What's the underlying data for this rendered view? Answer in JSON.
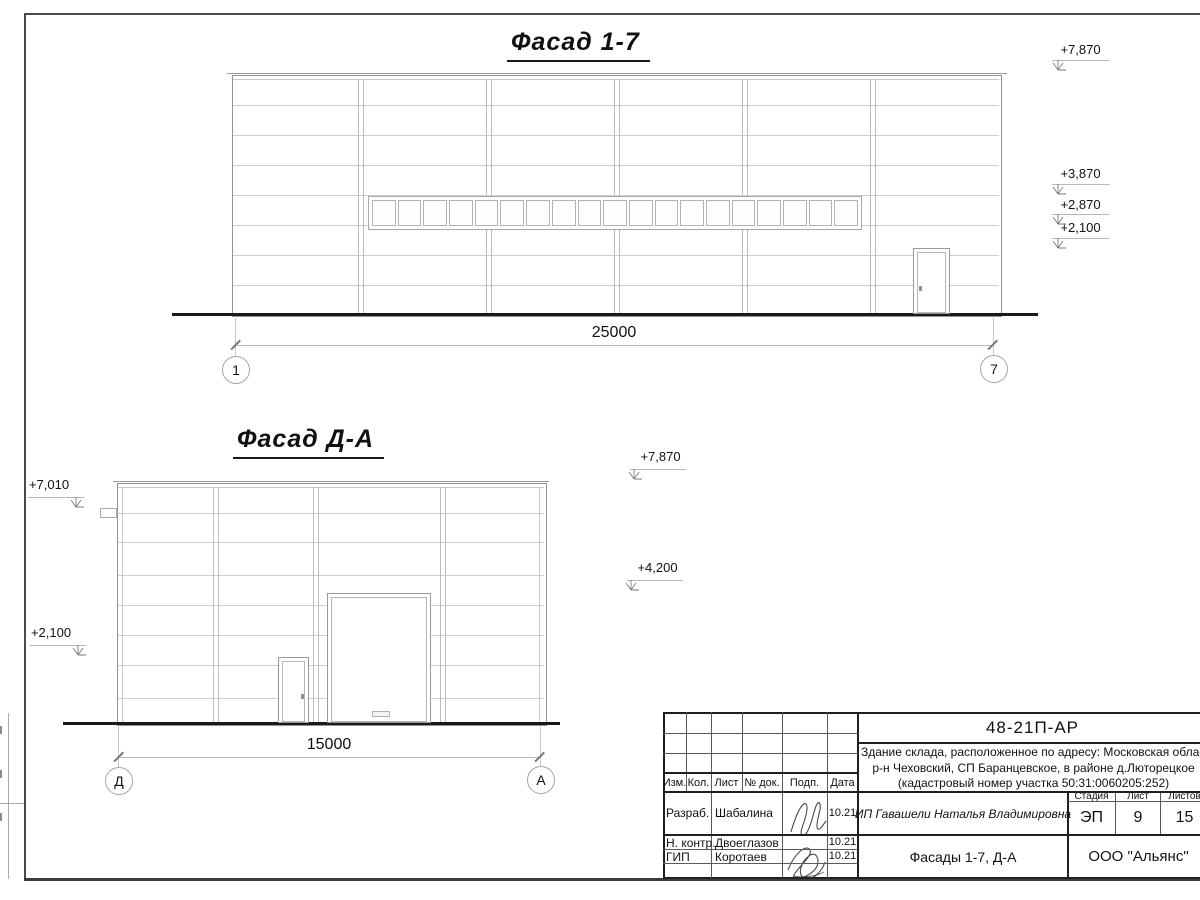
{
  "facade_1_7": {
    "title": "Фасад 1-7",
    "elevation_marks": [
      "+7,870",
      "+3,870",
      "+2,870",
      "+2,100"
    ],
    "dimension": "25000",
    "axis_start": "1",
    "axis_end": "7"
  },
  "facade_d_a": {
    "title": "Фасад Д-А",
    "elevation_marks_left": [
      "+7,010",
      "+2,100"
    ],
    "elevation_marks_right": [
      "+7,870",
      "+4,200"
    ],
    "dimension": "15000",
    "axis_start": "Д",
    "axis_end": "А"
  },
  "title_block": {
    "doc_number": "48-21П-АР",
    "project_description": [
      "Здание склада, расположенное по адресу: Московская область,",
      "р-н Чеховский, СП Баранцевское, в районе д.Люторецкое",
      "(кадастровый номер участка 50:31:0060205:252)"
    ],
    "table_headers": [
      "Изм.",
      "Кол.",
      "Лист",
      "№ док.",
      "Подп.",
      "Дата"
    ],
    "signers": [
      {
        "role": "Разраб.",
        "name": "Шабалина",
        "date": "10.21"
      },
      {
        "role": "Н. контр.",
        "name": "Двоеглазов",
        "date": "10.21"
      },
      {
        "role": "ГИП",
        "name": "Коротаев",
        "date": "10.21"
      }
    ],
    "client": "ИП Гавашели Наталья Владимировна",
    "stage_label": "Стадия",
    "stage_value": "ЭП",
    "sheet_label": "Лист",
    "sheet_value": "9",
    "sheets_total_label": "Листов",
    "sheets_total_value": "15",
    "drawing_title": "Фасады 1-7, Д-А",
    "company": "ООО \"Альянс\""
  },
  "colors": {
    "panel_line": "#cdcdcd",
    "outline": "#949494",
    "ground": "#191919",
    "frame": "#4a4a4a",
    "block_line": "#1f1f1f"
  }
}
